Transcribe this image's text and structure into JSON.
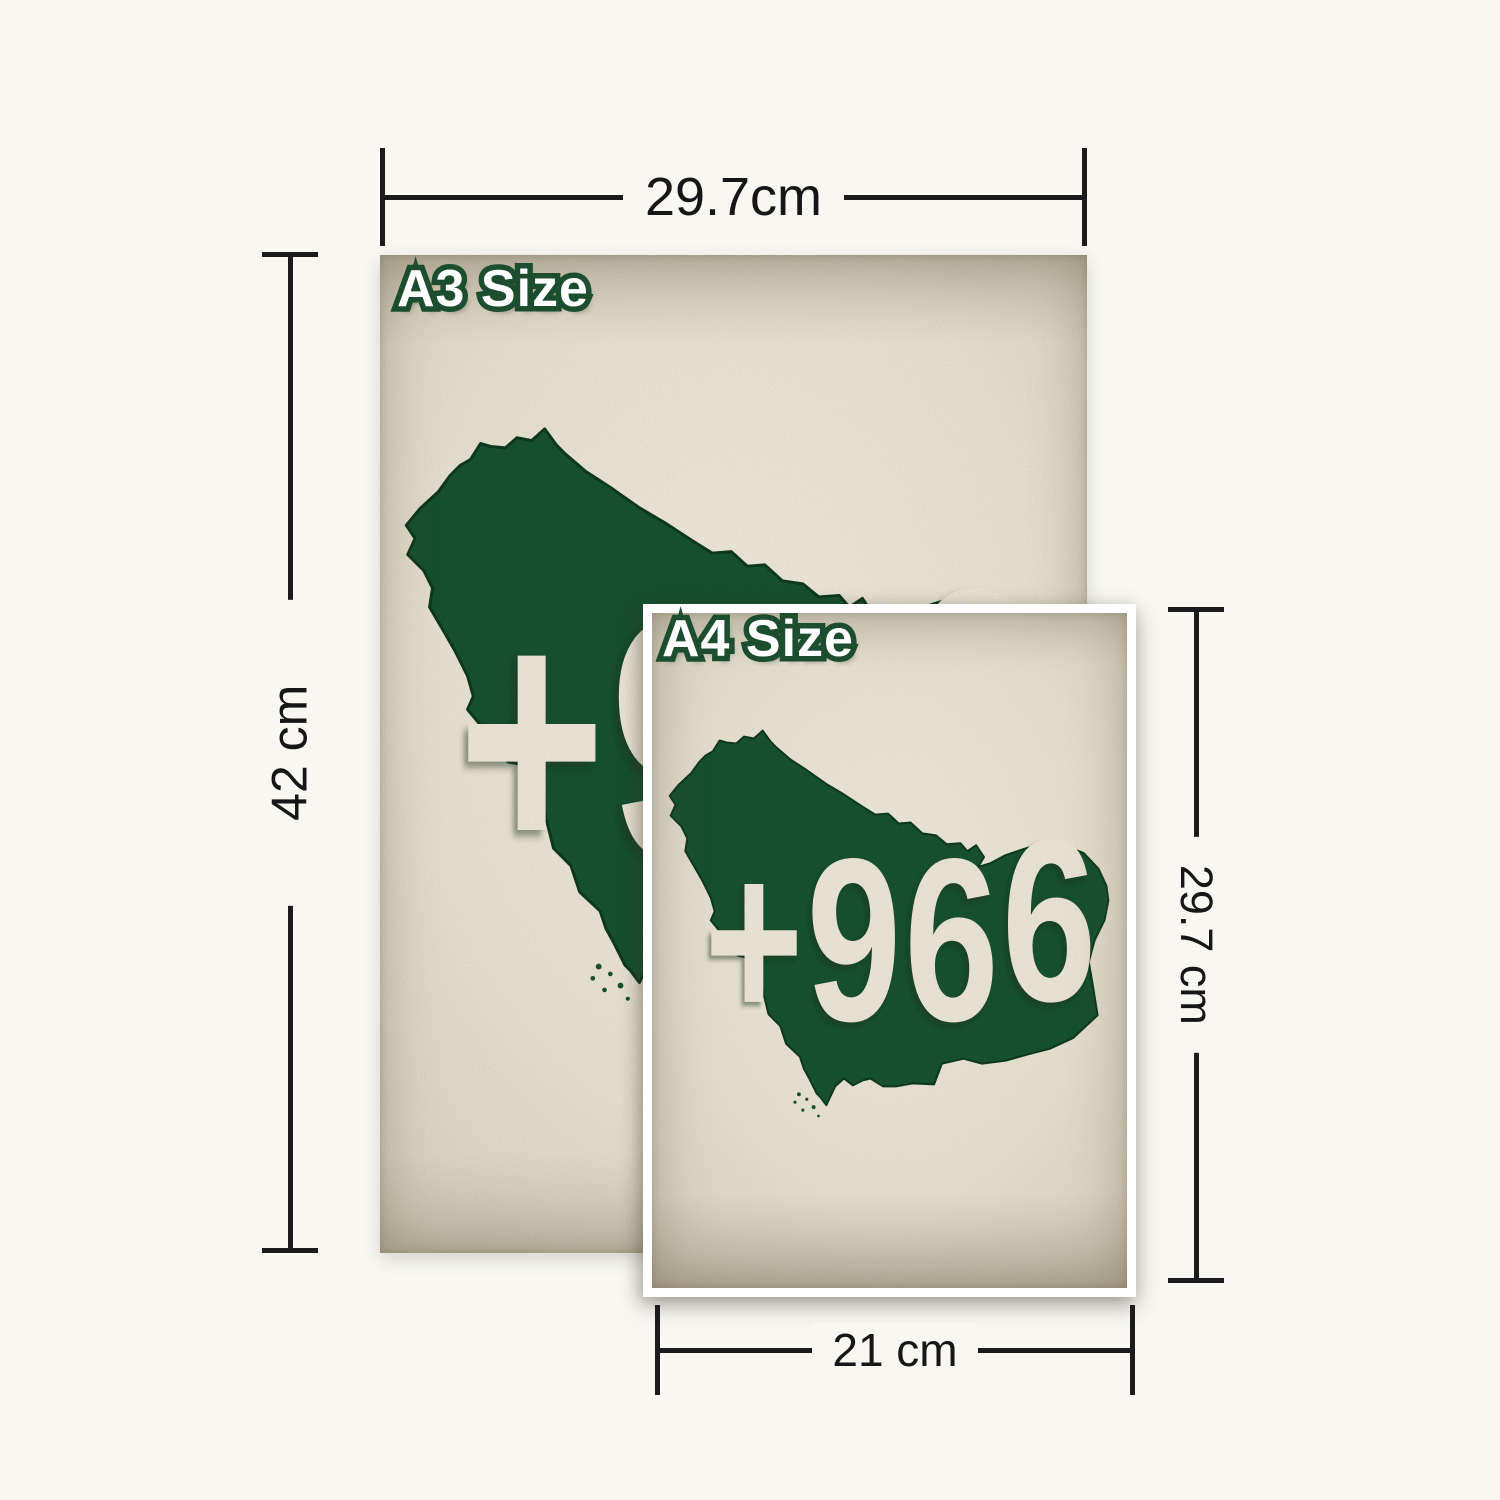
{
  "theme": {
    "map_green": "#1C5231",
    "paper_cream": "#EAE4D3",
    "page_bg": "#F8F7F2",
    "label_outline_green": "#1B4D2E",
    "label_fill": "#FFFFFF",
    "dim_line": "#1B1B1B",
    "text_cream": "#ECE7D7",
    "map_outline": "#123A22",
    "border_white": "#FFFFFF"
  },
  "posters": {
    "a3": {
      "label": "A3 Size"
    },
    "a4": {
      "label": "A4 Size"
    }
  },
  "artwork": {
    "subject": "saudi-arabia-map-silhouette",
    "country_code_prefix": "+96",
    "country_code_raised": "6"
  },
  "dimensions": {
    "a3_width": {
      "label": "29.7cm"
    },
    "a3_height": {
      "label": "42 cm"
    },
    "a4_width": {
      "label": "21 cm"
    },
    "a4_height": {
      "label": "29.7 cm"
    }
  }
}
